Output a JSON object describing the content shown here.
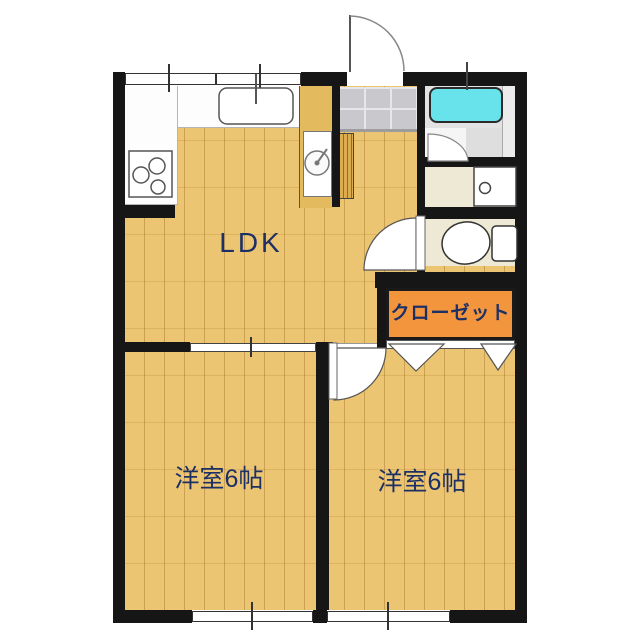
{
  "title": "apartment-floor-plan",
  "rooms": {
    "ldk": {
      "label": "LDK"
    },
    "bedroom_left": {
      "label": "洋室6帖"
    },
    "bedroom_right": {
      "label": "洋室6帖"
    },
    "closet": {
      "label": "クローゼット"
    }
  },
  "colors": {
    "wall": "#161616",
    "wood_floor": "#EBC26B",
    "closet_fill": "#F2953C",
    "bathtub": "#69E3EB",
    "entrance_tile": "#C8C8CD",
    "service_floor": "#EDE9D4",
    "label_text": "#1D3066"
  },
  "fixtures": [
    "kitchen-sink",
    "gas-stove",
    "washing-machine-space",
    "shoe-cabinet",
    "entrance-door",
    "bathtub",
    "bathroom-door",
    "washbasin",
    "toilet",
    "toilet-door",
    "closet-folding-doors",
    "bedroom-hinged-door",
    "sliding-door",
    "window"
  ]
}
